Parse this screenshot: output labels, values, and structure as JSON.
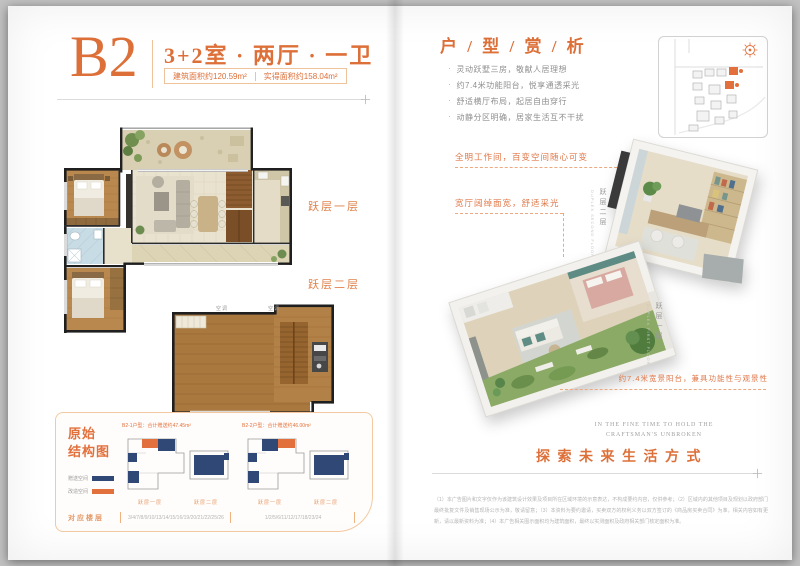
{
  "colors": {
    "accent": "#DD6F38",
    "legend_navy": "#2F4875",
    "legend_orange": "#E2703C"
  },
  "left": {
    "unit": "B2",
    "spec": "3+2室 · 两厅 · 一卫",
    "area_build": "建筑面积约120.59m²",
    "area_actual": "实得面积约158.04m²",
    "level1_label": "跃层一层",
    "level2_label": "跃层二层",
    "plan_note_1": "空调",
    "plan_note_2": "空调",
    "structure": {
      "title_line1": "原始",
      "title_line2": "结构图",
      "legend": [
        {
          "label": "赠送空间",
          "color": "#2F4875"
        },
        {
          "label": "改造空间",
          "color": "#E2703C"
        }
      ],
      "diagrams": [
        {
          "header": "B2-1户型：合计赠送约47.45m²",
          "label_a": "跃层一层",
          "label_b": "跃层二层",
          "floors": "3/4/7/8/9/10/13/14/15/16/19/20/21/22/25/26"
        },
        {
          "header": "B2-2户型：合计赠送约46.00m²",
          "label_a": "跃层一层",
          "label_b": "跃层二层",
          "floors": "1/2/5/6/11/12/17/18/23/24"
        }
      ],
      "floors_label": "对应楼层"
    }
  },
  "right": {
    "title": "户 / 型 / 赏 / 析",
    "bullets": [
      "灵动跃墅三房，敬献人居理想",
      "约7.4米功能阳台，悦享通透采光",
      "舒适横厅布局，起居自由穿行",
      "动静分区明确，居家生活互不干扰"
    ],
    "note_workroom": "全明工作间，百变空间随心可变",
    "note_living": "宽厅阔绰面宽，舒适采光",
    "note_balcony": "约7.4米宽景阳台，兼具功能性与观景性",
    "duplex2": {
      "cn": "跃层二层",
      "en": "DUPLEX SECOND FLOOR"
    },
    "duplex1": {
      "cn": "跃层一层",
      "en": "DUPLEX FIRST FLOOR"
    },
    "caption_en1": "IN THE FINE TIME TO HOLD THE",
    "caption_en2": "CRAFTSMAN'S UNBROKEN",
    "slogan": "探 索 未 来 生 活 方 式",
    "disclaimer": "（1）本广告图片和文字仅作为该建筑设计效果及项目所在区域环境的示意表达，不构成要约内容，仅供参考；（2）区域内的其他项目及规划以政府部门最终批复文件及销售现场公示为准，敬请留意；（3）本资料为要约邀请，买卖双方的权利义务以双方签订的《商品房买卖合同》为准，相关内容如有更新，请以最新资料为准；（4）本广告相关图示面积均为建筑面积，最终以实测面积及政府相关部门核定面积为准。"
  }
}
